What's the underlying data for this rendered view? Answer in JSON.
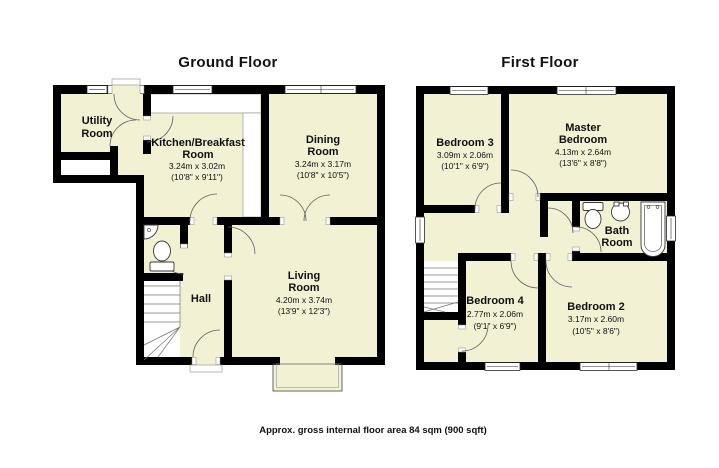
{
  "colors": {
    "room_fill": "#f2f1d4",
    "wall": "#000000",
    "door_arc": "#606060",
    "thin_line": "#9a9a9a",
    "text_color": "#111111",
    "page_bg": "#ffffff"
  },
  "ground_floor": {
    "title": "Ground Floor",
    "rooms": {
      "utility": {
        "line1": "Utility",
        "line2": "Room"
      },
      "kitchen": {
        "line1": "Kitchen/Breakfast",
        "line2": "Room",
        "dims_m": "3.24m x 3.02m",
        "dims_ft": "(10'8\" x 9'11\")"
      },
      "dining": {
        "line1": "Dining",
        "line2": "Room",
        "dims_m": "3.24m x 3.17m",
        "dims_ft": "(10'8\" x 10'5\")"
      },
      "hall": {
        "line1": "Hall"
      },
      "living": {
        "line1": "Living",
        "line2": "Room",
        "dims_m": "4.20m x 3.74m",
        "dims_ft": "(13'9\" x 12'3\")"
      }
    }
  },
  "first_floor": {
    "title": "First Floor",
    "rooms": {
      "bedroom3": {
        "line1": "Bedroom 3",
        "dims_m": "3.09m x 2.06m",
        "dims_ft": "(10'1\" x 6'9\")"
      },
      "master": {
        "line1": "Master",
        "line2": "Bedroom",
        "dims_m": "4.13m x 2.64m",
        "dims_ft": "(13'6\" x 8'8\")"
      },
      "bathroom": {
        "line1": "Bath",
        "line2": "Room"
      },
      "bedroom4": {
        "line1": "Bedroom 4",
        "dims_m": "2.77m x 2.06m",
        "dims_ft": "(9'1\" x 6'9\")"
      },
      "bedroom2": {
        "line1": "Bedroom 2",
        "dims_m": "3.17m x 2.60m",
        "dims_ft": "(10'5\" x 8'6\")"
      }
    }
  },
  "caption": "Approx. gross internal floor area 84 sqm (900 sqft)"
}
